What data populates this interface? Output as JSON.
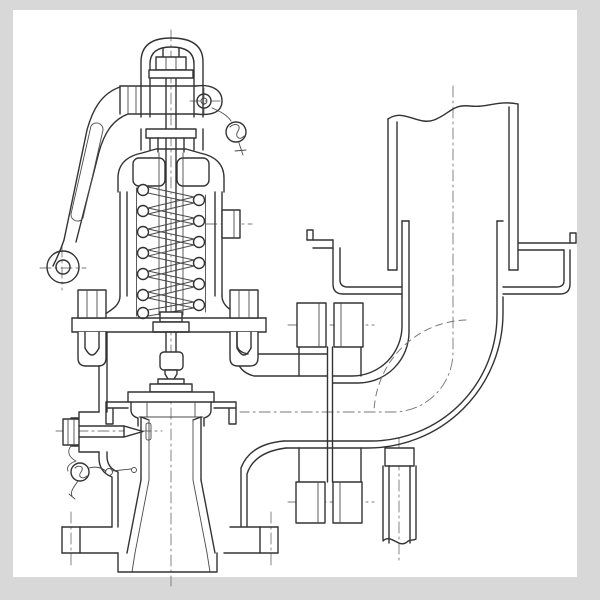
{
  "figure": {
    "title": "Lever-type spring-loaded safety valve with drip-pan elbow and vent riser — sectional engineering drawing",
    "type": "technical-line-drawing",
    "visible_text": []
  },
  "colors": {
    "line": "#333333",
    "thin": "#4a4a4a",
    "center": "#787878",
    "frame": "#d8d8d8",
    "paper": "#ffffff"
  },
  "components": [
    "fork-yoke",
    "spindle-adjusting-nut",
    "lifting-lever",
    "lever-fulcrum-pin",
    "lead-seal-upper",
    "spring-bonnet",
    "helical-spring",
    "valve-spindle",
    "bonnet-flange-studs",
    "valve-body",
    "valve-disc",
    "seat-nozzle",
    "test-gag-screw",
    "lead-seal-lower",
    "inlet-flange",
    "outlet-flange-joint",
    "discharge-elbow",
    "drip-pan",
    "vent-riser-pipe",
    "drain-pipe",
    "centerlines"
  ]
}
